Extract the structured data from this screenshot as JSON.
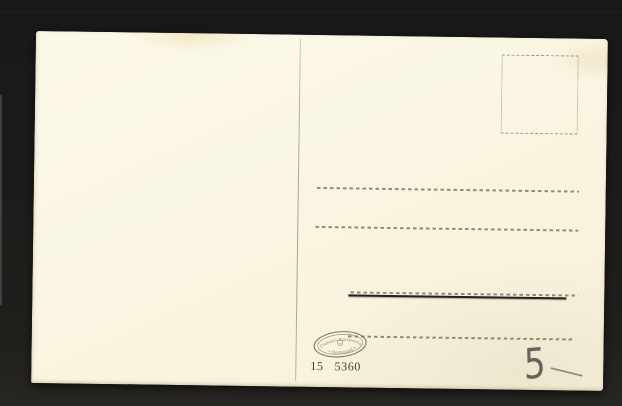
{
  "photo": {
    "subject": "blank postcard back on dark mount",
    "colors": {
      "backdrop": "#1c1c1c",
      "card": "#faf5e2",
      "dashed_line": "#8a8475",
      "divider_line": "#b3ab97",
      "solid_underline": "#23221f",
      "stamp_ink": "#7a7362",
      "print_ink": "#3f3d38",
      "pencil": "#504e49"
    }
  },
  "publisher_stamp": {
    "arc_text": "Cramers Kunstanstalt",
    "bottom_text": "• Dortmund •"
  },
  "print_code": {
    "series": "15",
    "number": "5360"
  },
  "handwritten": {
    "price": "5",
    "dash": "—"
  }
}
